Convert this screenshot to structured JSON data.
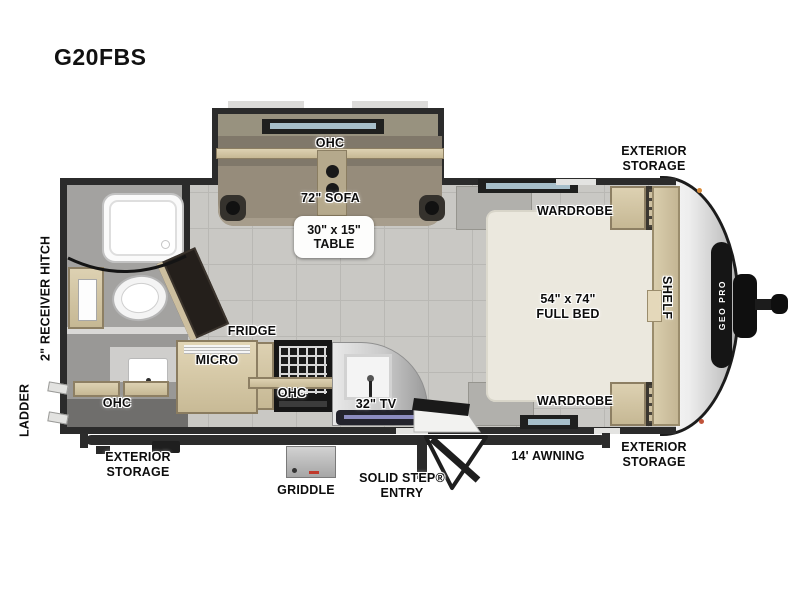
{
  "model": "G20FBS",
  "brand_badge": "GEO PRO",
  "labels": {
    "ohc": "OHC",
    "sofa": "72\" SOFA",
    "table_line1": "30\" x 15\"",
    "table_line2": "TABLE",
    "wardrobe": "WARDROBE",
    "exterior_storage": "EXTERIOR STORAGE",
    "shelf": "SHELF",
    "bed_line1": "54\" x 74\"",
    "bed_line2": "FULL BED",
    "fridge": "FRIDGE",
    "micro": "MICRO",
    "tv": "32\" TV",
    "awning": "14' AWNING",
    "solid_step_line1": "SOLID STEP®",
    "solid_step_line2": "ENTRY",
    "griddle": "GRIDDLE",
    "ladder": "LADDER",
    "receiver_hitch": "2\" RECEIVER HITCH"
  },
  "colors": {
    "wall": "#2b2b2b",
    "floor": "#c9c8c4",
    "wood": "#d5c8a7",
    "bed": "#ebe8de",
    "sofa": "#968c7b",
    "accent_orange": "#d98b3a"
  }
}
